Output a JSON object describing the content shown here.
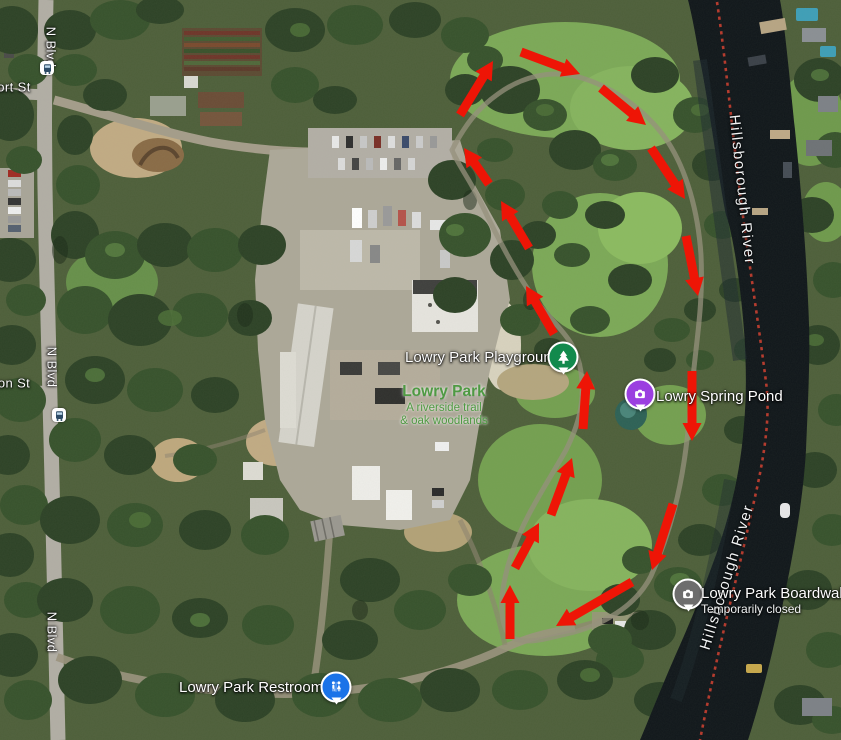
{
  "streets": [
    {
      "label": "N Blvd"
    },
    {
      "label": "ort St"
    },
    {
      "label": "N Blvd"
    },
    {
      "label": "on St"
    },
    {
      "label": "N Blvd"
    }
  ],
  "rivers": [
    {
      "label": "Hillsborough River"
    },
    {
      "label": "Hillsborough River"
    }
  ],
  "pois": [
    {
      "label": "Lowry Park Playground",
      "icon": "tree-icon"
    },
    {
      "label": "Lowry Park",
      "sub1": "A riverside trail",
      "sub2": "& oak woodlands"
    },
    {
      "label": "Lowry Spring Pond",
      "icon": "camera-icon"
    },
    {
      "label": "Lowry Park Boardwalk",
      "sub": "Temporarily closed",
      "icon": "camera-icon"
    },
    {
      "label": "Lowry Park Restrooms",
      "icon": "restroom-icon"
    }
  ],
  "colors": {
    "arrow": "#ee1506",
    "boom_line": "#c03a2c",
    "pin_green": "#128a4d",
    "pin_purple": "#9b3fe0",
    "pin_gray": "#6d6d6d",
    "pin_blue": "#1a73e8",
    "park_label_green": "#4f9a43"
  },
  "route_arrows": [
    {
      "x1": 489,
      "y1": 184,
      "x2": 464,
      "y2": 148
    },
    {
      "x1": 529,
      "y1": 248,
      "x2": 501,
      "y2": 201
    },
    {
      "x1": 554,
      "y1": 334,
      "x2": 526,
      "y2": 286
    },
    {
      "x1": 460,
      "y1": 115,
      "x2": 493,
      "y2": 61
    },
    {
      "x1": 521,
      "y1": 52,
      "x2": 580,
      "y2": 74
    },
    {
      "x1": 601,
      "y1": 88,
      "x2": 646,
      "y2": 125
    },
    {
      "x1": 651,
      "y1": 148,
      "x2": 685,
      "y2": 199
    },
    {
      "x1": 686,
      "y1": 236,
      "x2": 698,
      "y2": 296
    },
    {
      "x1": 692,
      "y1": 371,
      "x2": 692,
      "y2": 441
    },
    {
      "x1": 673,
      "y1": 504,
      "x2": 652,
      "y2": 570
    },
    {
      "x1": 632,
      "y1": 582,
      "x2": 556,
      "y2": 626
    },
    {
      "x1": 510,
      "y1": 639,
      "x2": 510,
      "y2": 585
    },
    {
      "x1": 515,
      "y1": 568,
      "x2": 539,
      "y2": 523
    },
    {
      "x1": 551,
      "y1": 515,
      "x2": 572,
      "y2": 458
    },
    {
      "x1": 583,
      "y1": 429,
      "x2": 587,
      "y2": 371
    }
  ]
}
